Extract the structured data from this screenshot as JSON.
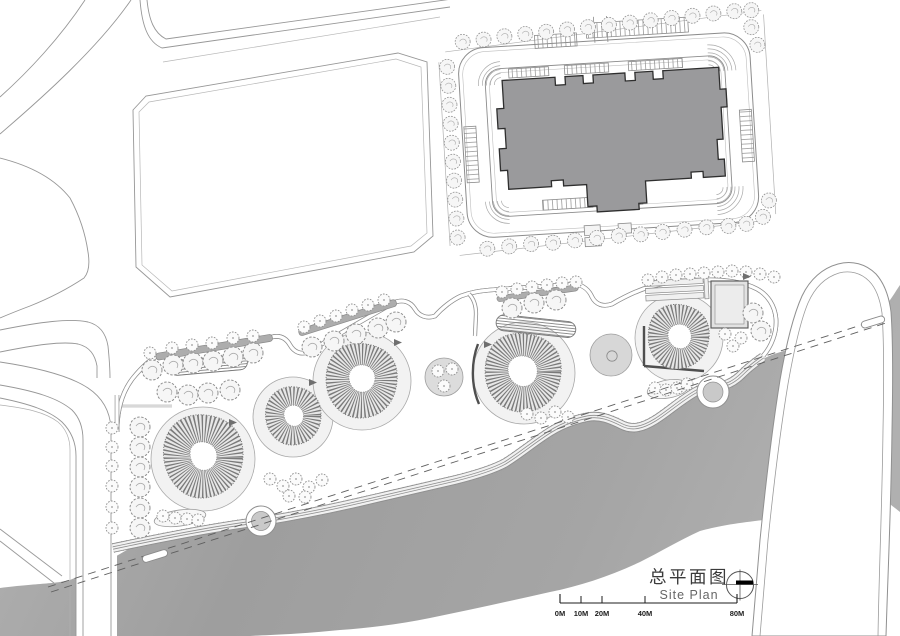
{
  "title_block": {
    "title_cn": "总平面图",
    "title_en": "Site Plan",
    "compass_icon": "north-arrow-compass-icon"
  },
  "scale_bar": {
    "labels": [
      "0M",
      "10M",
      "20M",
      "40M",
      "80M"
    ]
  },
  "colors": {
    "paper": "#ffffff",
    "linework": "#8f8f8f",
    "building_fill": "#9a9a9c",
    "building_outline": "#2e2e2e",
    "river_light": "#b4b4b4",
    "river_mid": "#9e9e9e",
    "river_end": "#b0b0b0",
    "plaza_fill": "#d7d7d7",
    "planter_fill": "#dcdcdc",
    "pavilion_fill": "#e2e2e2",
    "hedge_fill": "#adadad",
    "node_fill": "#c9c9c9",
    "mound_hatch": "#7a7a7a",
    "wall": "#4f4f4f"
  },
  "features": {
    "roads": "city-road-network",
    "building": "apartment-building-footprint",
    "parking": "parking-stall-rows",
    "perimeter_trees": "street-tree-ring",
    "park_mounds": [
      "planted-mound-1",
      "planted-mound-2",
      "planted-mound-3",
      "planted-mound-4",
      "planted-mound-5"
    ],
    "plaza": "circular-plaza",
    "pavilion": "square-pavilion",
    "promenade": "riverside-promenade",
    "nodes": [
      "promenade-node-1",
      "promenade-node-2"
    ],
    "river": "river",
    "ferry_route": "dashed-river-crossing",
    "piers": [
      "pier-capsule-west",
      "pier-capsule-east"
    ]
  }
}
